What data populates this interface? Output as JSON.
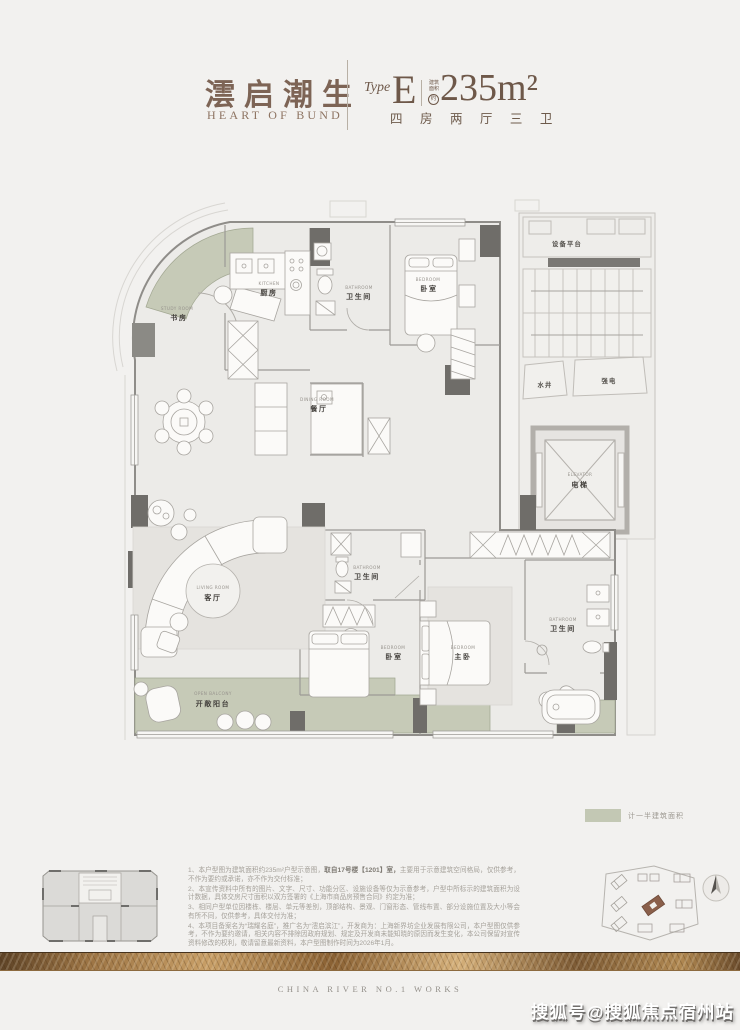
{
  "header": {
    "brand_cn": "澐启潮生",
    "brand_en": "HEART OF BUND",
    "type_label": "Type",
    "type_letter": "E",
    "area_prefix_line1": "建筑",
    "area_prefix_line2": "面积",
    "area_approx": "约",
    "area_value": "235m²",
    "layout_spec": "四 房 两 厅 三 卫"
  },
  "plan": {
    "rooms": {
      "study": {
        "en": "STUDY ROOM",
        "cn": "书房"
      },
      "kitchen": {
        "en": "KITCHEN",
        "cn": "厨房"
      },
      "bath_top": {
        "en": "BATHROOM",
        "cn": "卫生间"
      },
      "bedroom_top": {
        "en": "BEDROOM",
        "cn": "卧室"
      },
      "dining": {
        "en": "DINING ROOM",
        "cn": "餐厅"
      },
      "living": {
        "en": "LIVING ROOM",
        "cn": "客厅"
      },
      "balcony": {
        "en": "OPEN BALCONY",
        "cn": "开敞阳台"
      },
      "bath_mid": {
        "en": "BATHROOM",
        "cn": "卫生间"
      },
      "bedroom_second": {
        "en": "BEDROOM",
        "cn": "卧室"
      },
      "bedroom_master": {
        "en": "BEDROOM",
        "cn": "主卧"
      },
      "bath_master": {
        "en": "BATHROOM",
        "cn": "卫生间"
      },
      "elevator": {
        "en": "ELEVATOR",
        "cn": "电梯"
      },
      "equipment_platform": {
        "cn": "设备平台"
      },
      "water_shaft": {
        "cn": "水井"
      },
      "power_shaft": {
        "cn": "强电"
      }
    },
    "legend": {
      "label": "计一半建筑面积",
      "swatch_color": "#c3c8b4"
    }
  },
  "notes": {
    "item1_pre": "1、本户型图为建筑面积约235m²户型示意图，",
    "item1_bold": "取自17号楼【1201】室，",
    "item1_post": "主要用于示意建筑空间格局，仅供参考，不作为要约或承诺，亦不作为交付标准；",
    "item2": "2、本宣传资料中所有的图片、文字、尺寸、功能分区、设施设备等仅为示意参考，户型中所标示的建筑面积为设计数据，具体交房尺寸面积以双方签署的《上海市商品房预售合同》约定为准；",
    "item3": "3、相同户型单位因楼栋、楼层、单元等差别，顶部结构、景观、门窗形态、管线布置、部分设施位置及大小等会有所不同，仅供参考，具体交付为准；",
    "item4": "4、本项目备案名为“瑞耀名庭”，推广名为“澐启滨江”，开发商为：上海新界坊企业发展有限公司，本户型图仅供参考，不作为要约邀请，相关内容不排除因政府规划、规定及开发商未能知晓的原因而发生变化，本公司保留对宣传资料修改的权利，敬请留意最新资料，本户型图制作时间为2026年1月。"
  },
  "footer": {
    "works_label": "CHINA RIVER NO.1 WORKS"
  },
  "watermark": {
    "text": "搜狐号@搜狐焦点宿州站"
  },
  "colors": {
    "sage": "#c3c8b4",
    "brand_brown": "#7d6455",
    "wall_dark": "#6f6d69",
    "gold": "#c79e66"
  }
}
